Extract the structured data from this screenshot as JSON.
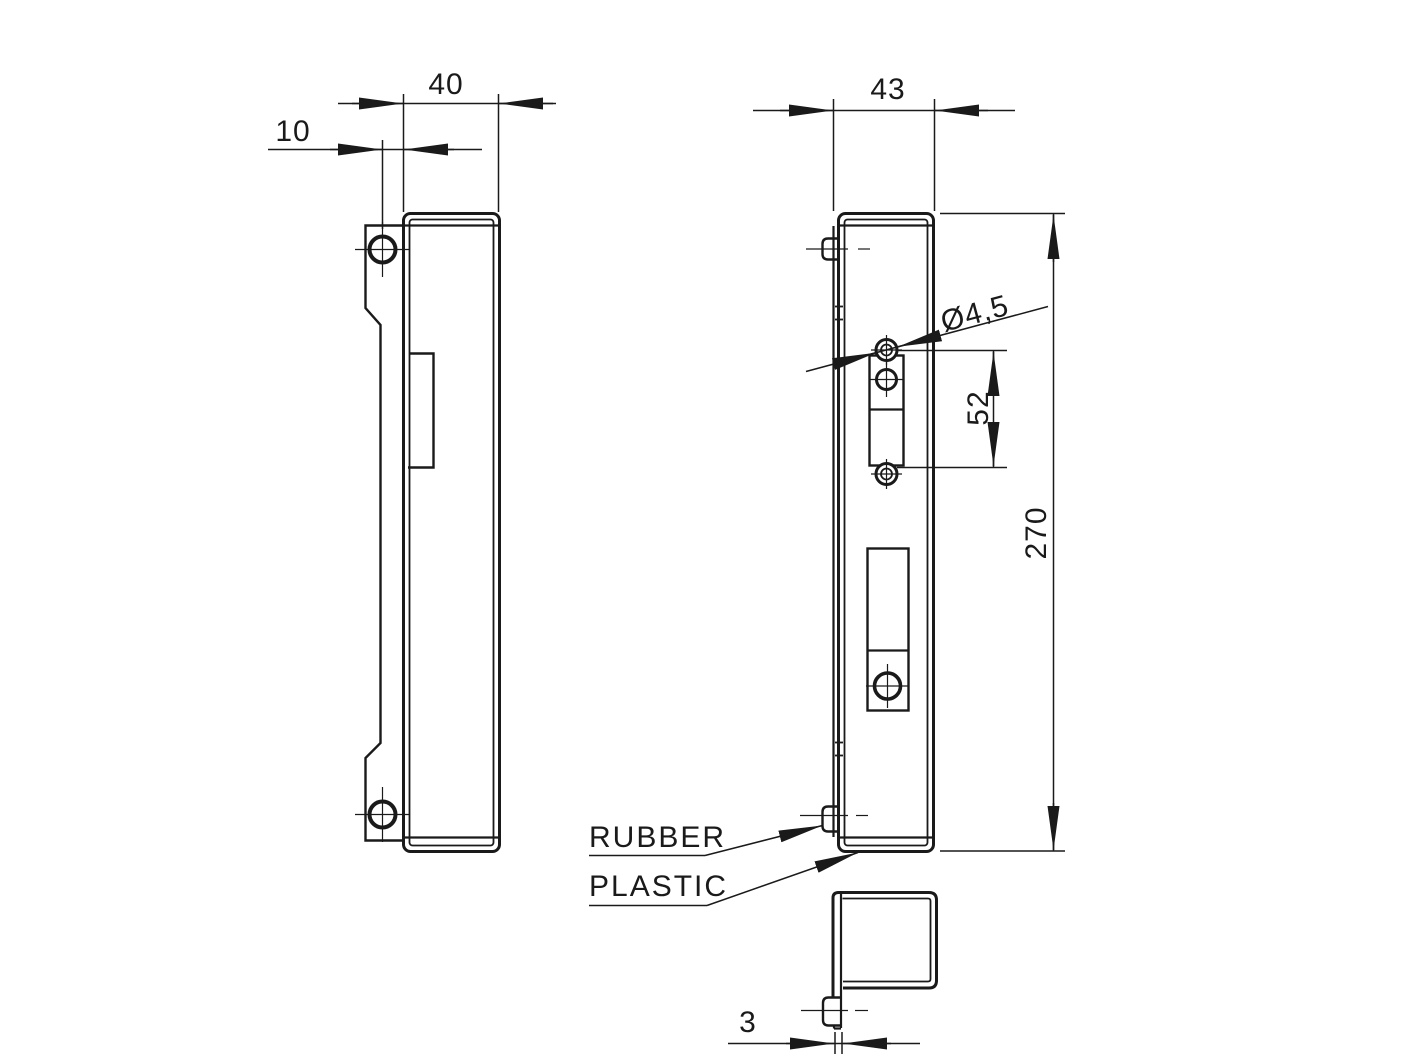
{
  "page": {
    "background": "#ffffff",
    "line_color": "#1a1a1a"
  },
  "front_view": {
    "dim_width": "40",
    "dim_hole_offset": "10"
  },
  "side_view": {
    "dim_depth": "43",
    "dim_hole_diameter": "Ø4,5",
    "dim_hole_spacing": "52",
    "dim_height": "270"
  },
  "detail_view": {
    "dim_thickness": "3"
  },
  "callouts": {
    "rubber": "RUBBER",
    "plastic": "PLASTIC"
  }
}
